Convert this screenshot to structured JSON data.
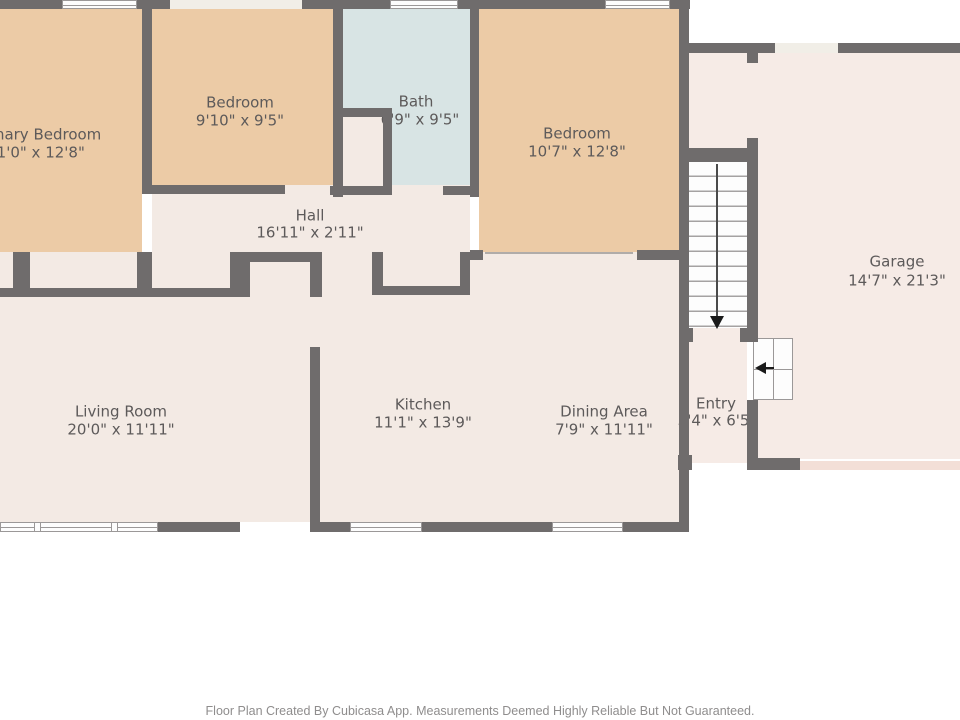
{
  "rooms": {
    "primary_bedroom": {
      "name": "Primary Bedroom",
      "dims": "11'0\" x 12'8\""
    },
    "bedroom_2": {
      "name": "Bedroom",
      "dims": "9'10\" x 9'5\""
    },
    "bath": {
      "name": "Bath",
      "dims": "6'9\" x 9'5\""
    },
    "bedroom_3": {
      "name": "Bedroom",
      "dims": "10'7\" x 12'8\""
    },
    "hall": {
      "name": "Hall",
      "dims": "16'11\" x 2'11\""
    },
    "living_room": {
      "name": "Living Room",
      "dims": "20'0\" x 11'11\""
    },
    "kitchen": {
      "name": "Kitchen",
      "dims": "11'1\" x 13'9\""
    },
    "dining_area": {
      "name": "Dining Area",
      "dims": "7'9\" x 11'11\""
    },
    "entry": {
      "name": "Entry",
      "dims": "3'4\" x 6'5\""
    },
    "garage": {
      "name": "Garage",
      "dims": "14'7\" x 21'3\""
    }
  },
  "icons": {
    "stairs_direction": "down-arrow",
    "entry_direction": "left-arrow"
  },
  "footer": {
    "disclaimer": "Floor Plan Created By Cubicasa App. Measurements Deemed Highly Reliable But Not Guaranteed."
  },
  "colors": {
    "wall": "#6f6c6c",
    "bedroom_fill": "#eccba6",
    "bath_fill": "#d8e4e4",
    "floor_fill": "#f3eae4",
    "garage_fill": "#f6ebe6",
    "window_fill": "#fdfdfd",
    "label_text": "#5d5a5a",
    "disclaimer_text": "#8f8d8d"
  }
}
